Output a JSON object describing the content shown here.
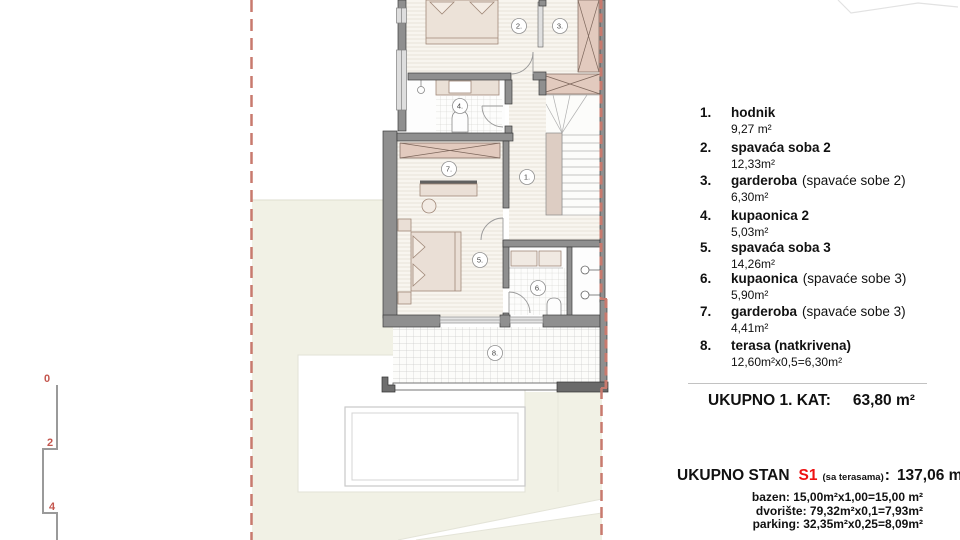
{
  "colors": {
    "boundary_red": "#c87a6e",
    "unit_red": "#e11111",
    "wall_gray": "#8f8f8f",
    "furniture_fill": "#eadfd6",
    "wardrobe_pink": "#e2cabe",
    "yard_green": "#f1f1e5"
  },
  "plan": {
    "room_labels": [
      "1.",
      "2.",
      "3.",
      "4.",
      "5.",
      "6.",
      "7.",
      "8."
    ],
    "scale_labels": [
      "0",
      "2",
      "4"
    ]
  },
  "legend": {
    "items": [
      {
        "num": "1.",
        "name": "hodnik",
        "note": "",
        "area": "9,27 m²"
      },
      {
        "num": "2.",
        "name": "spavaća soba 2",
        "note": "",
        "area": "12,33m²"
      },
      {
        "num": "3.",
        "name": "garderoba",
        "note": "(spavaće sobe 2)",
        "area": "6,30m²"
      },
      {
        "num": "4.",
        "name": "kupaonica 2",
        "note": "",
        "area": "5,03m²"
      },
      {
        "num": "5.",
        "name": "spavaća soba 3",
        "note": "",
        "area": "14,26m²"
      },
      {
        "num": "6.",
        "name": "kupaonica",
        "note": "(spavaće sobe 3)",
        "area": "5,90m²"
      },
      {
        "num": "7.",
        "name": "garderoba",
        "note": "(spavaće sobe 3)",
        "area": "4,41m²"
      },
      {
        "num": "8.",
        "name": "terasa (natkrivena)",
        "note": "",
        "area": "12,60m²x0,5=6,30m²"
      }
    ],
    "floor_total": {
      "label": "UKUPNO 1. KAT:",
      "value": "63,80 m²"
    },
    "unit_total": {
      "prefix": "UKUPNO STAN",
      "unit": "S1",
      "note": "(sa terasama)",
      "colon": ":",
      "value": "137,06 m²"
    },
    "extras": [
      "bazen: 15,00m²x1,00=15,00 m²",
      "dvorište: 79,32m²x0,1=7,93m²",
      "parking: 32,35m²x0,25=8,09m²"
    ]
  }
}
